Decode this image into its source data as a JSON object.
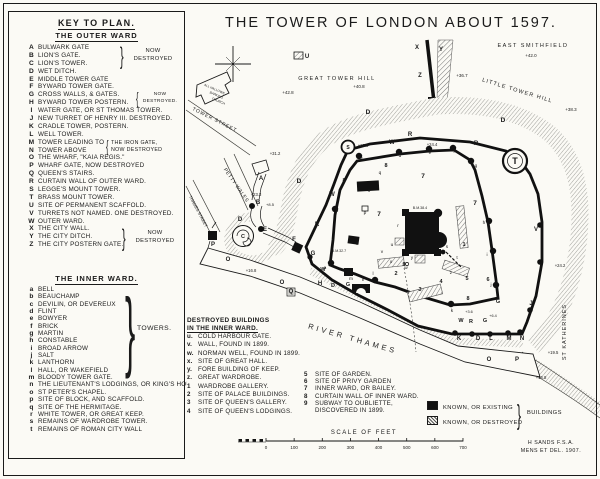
{
  "key": {
    "heading": "KEY TO PLAN.",
    "subheading": "THE OUTER WARD",
    "inner_heading": "THE INNER WARD.",
    "outer_ward": [
      {
        "k": "A",
        "label": "BULWARK GATE"
      },
      {
        "k": "B",
        "label": "LION'S GATE."
      },
      {
        "k": "C",
        "label": "LION'S TOWER."
      },
      {
        "k": "D",
        "label": "WET DITCH."
      },
      {
        "k": "E",
        "label": "MIDDLE TOWER GATE"
      },
      {
        "k": "F",
        "label": "BYWARD TOWER GATE."
      },
      {
        "k": "G",
        "label": "CROSS WALLS, & GATES."
      },
      {
        "k": "H",
        "label": "BYWARD TOWER POSTERN."
      },
      {
        "k": "I",
        "label": "WATER GATE, OR ST THOMAS TOWER."
      },
      {
        "k": "J",
        "label": "NEW TURRET OF HENRY III. DESTROYED."
      },
      {
        "k": "K",
        "label": "CRADLE TOWER, POSTERN."
      },
      {
        "k": "L",
        "label": "WELL TOWER."
      },
      {
        "k": "M",
        "label": "TOWER LEADING TO"
      },
      {
        "k": "N",
        "label": "TOWER ABOVE"
      },
      {
        "k": "O",
        "label": "THE WHARF, \"KAIA REGIS.\""
      },
      {
        "k": "P",
        "label": "WHARF GATE, NOW DESTROYED"
      },
      {
        "k": "Q",
        "label": "QUEEN'S STAIRS."
      },
      {
        "k": "R",
        "label": "CURTAIN WALL OF OUTER WARD."
      },
      {
        "k": "S",
        "label": "LEGGE'S MOUNT TOWER."
      },
      {
        "k": "T",
        "label": "BRASS MOUNT TOWER."
      },
      {
        "k": "U",
        "label": "SITE OF PERMANENT SCAFFOLD."
      },
      {
        "k": "V",
        "label": "TURRETS NOT NAMED. ONE DESTROYED."
      },
      {
        "k": "W",
        "label": "OUTER WARD."
      },
      {
        "k": "X",
        "label": "THE CITY WALL."
      },
      {
        "k": "Y",
        "label": "THE CITY DITCH."
      },
      {
        "k": "Z",
        "label": "THE CITY POSTERN GATE."
      }
    ],
    "inner_ward": [
      {
        "k": "a",
        "label": "BELL"
      },
      {
        "k": "b",
        "label": "BEAUCHAMP"
      },
      {
        "k": "c",
        "label": "DEVILIN, OR DEVEREUX"
      },
      {
        "k": "d",
        "label": "FLINT"
      },
      {
        "k": "e",
        "label": "BOWYER"
      },
      {
        "k": "f",
        "label": "BRICK"
      },
      {
        "k": "g",
        "label": "MARTIN"
      },
      {
        "k": "h",
        "label": "CONSTABLE"
      },
      {
        "k": "i",
        "label": "BROAD ARROW"
      },
      {
        "k": "j",
        "label": "SALT"
      },
      {
        "k": "k",
        "label": "LANTHORN"
      },
      {
        "k": "l",
        "label": "HALL, OR WAKEFIELD"
      },
      {
        "k": "m",
        "label": "BLOODY TOWER GATE."
      },
      {
        "k": "n",
        "label": "THE LIEUTENANT'S LODGINGS, OR KING'S HOUSE"
      },
      {
        "k": "o",
        "label": "ST PETER'S CHAPEL."
      },
      {
        "k": "p",
        "label": "SITE OF BLOCK, AND SCAFFOLD."
      },
      {
        "k": "q",
        "label": "SITE OF THE HERMITAGE."
      },
      {
        "k": "r",
        "label": "WHITE TOWER, OR GREAT KEEP."
      },
      {
        "k": "s",
        "label": "REMAINS OF WARDROBE TOWER."
      },
      {
        "k": "t",
        "label": "REMAINS OF ROMAN CITY WALL"
      }
    ],
    "towers_brace_label": "TOWERS.",
    "braces": {
      "abc": [
        "NOW",
        "DESTROYED"
      ],
      "gh": [
        "NOW",
        "DESTROYED."
      ],
      "mn": [
        "THE IRON GATE,",
        "NOW DESTROYED"
      ],
      "xyz": [
        "NOW",
        "DESTROYED"
      ]
    },
    "brace_glyphs": {
      "close": "}",
      "open": "{"
    }
  },
  "destroyed": {
    "heading1": "DESTROYED BUILDINGS",
    "heading2": "IN THE INNER WARD.",
    "col1": [
      {
        "k": "u.",
        "label": "COLD HARBOUR GATE."
      },
      {
        "k": "v.",
        "label": "WALL, FOUND IN 1899."
      },
      {
        "k": "w.",
        "label": "NORMAN WELL, FOUND IN 1899."
      },
      {
        "k": "x.",
        "label": "SITE OF GREAT HALL."
      },
      {
        "k": "y.",
        "label": "FORE BUILDING OF KEEP."
      },
      {
        "k": "z.",
        "label": "GREAT WARDROBE."
      },
      {
        "k": "1",
        "label": "WARDROBE GALLERY."
      },
      {
        "k": "2",
        "label": "SITE OF PALACE BUILDINGS."
      },
      {
        "k": "3",
        "label": "SITE OF QUEEN'S GALLERY."
      },
      {
        "k": "4",
        "label": "SITE OF QUEEN'S LODGINGS."
      }
    ],
    "col2": [
      {
        "k": "5",
        "label": "SITE OF GARDEN."
      },
      {
        "k": "6",
        "label": "SITE OF PRIVY GARDEN"
      },
      {
        "k": "7",
        "label": "INNER WARD, OR BAILEY."
      },
      {
        "k": "8",
        "label": "CURTAIN WALL OF INNER WARD."
      },
      {
        "k": "9",
        "label": "SUBWAY TO OUBLIETTE,"
      },
      {
        "k": "",
        "label": "DISCOVERED IN 1899."
      }
    ]
  },
  "legend": {
    "existing": "KNOWN, OR EXISTING",
    "destroyed": "KNOWN, OR DESTROYED",
    "brace_label": "BUILDINGS"
  },
  "scale": {
    "label": "SCALE OF FEET",
    "ticks": [
      "0",
      "100",
      "200",
      "300",
      "400",
      "500",
      "600",
      "700"
    ]
  },
  "signature": {
    "line1": "H SANDS  F.S.A.",
    "line2": "MENS ET DEL. 1907."
  },
  "map": {
    "markers": [
      {
        "t": "THE TOWER OF LONDON ABOUT 1597.",
        "x": 391,
        "y": 27,
        "fs": 14.5,
        "ls": 2,
        "n": "map-title"
      },
      {
        "t": "EAST SMITHFIELD",
        "x": 533,
        "y": 47,
        "fs": 5.5,
        "ls": 1.5,
        "n": "east-smithfield-label"
      },
      {
        "t": "+42.0",
        "x": 531,
        "y": 57,
        "fs": 4.5
      },
      {
        "t": "GREAT TOWER HILL",
        "x": 337,
        "y": 80,
        "fs": 5.5,
        "ls": 1.5,
        "n": "great-tower-hill-label"
      },
      {
        "t": "+40.8",
        "x": 359,
        "y": 88,
        "fs": 4.5
      },
      {
        "t": "+42.8",
        "x": 288,
        "y": 94,
        "fs": 4.5
      },
      {
        "t": "LITTLE TOWER HILL",
        "x": 517,
        "y": 92,
        "fs": 5.5,
        "ls": 1.2,
        "r": 17,
        "n": "little-tower-hill-label"
      },
      {
        "t": "+38.3",
        "x": 571,
        "y": 111,
        "fs": 4.5
      },
      {
        "t": "+36.7",
        "x": 462,
        "y": 77,
        "fs": 4.5
      },
      {
        "t": "+31.2",
        "x": 275,
        "y": 155,
        "fs": 4.2
      },
      {
        "t": "TOWER STREET",
        "x": 214,
        "y": 121,
        "fs": 5,
        "ls": 0.8,
        "r": 27,
        "n": "tower-street-label"
      },
      {
        "t": "PETTY WALES",
        "x": 235,
        "y": 186,
        "fs": 5,
        "ls": 0.5,
        "r": 55,
        "n": "petty-wales-label"
      },
      {
        "t": "THAMES STREET",
        "x": 197,
        "y": 212,
        "fs": 4.2,
        "r": 62,
        "n": "thames-street-label"
      },
      {
        "t": "ALL HALLOWS",
        "x": 214,
        "y": 90,
        "fs": 3.2,
        "r": 24
      },
      {
        "t": "BARKING",
        "x": 216,
        "y": 96,
        "fs": 3.2,
        "r": 24
      },
      {
        "t": "CHURCH",
        "x": 218,
        "y": 102,
        "fs": 3.2,
        "r": 24
      },
      {
        "t": "RIVER THAMES",
        "x": 352,
        "y": 341,
        "fs": 7.5,
        "ls": 3,
        "r": 16,
        "n": "river-thames-label"
      },
      {
        "t": "ST KATHERINES",
        "x": 566,
        "y": 332,
        "fs": 5.5,
        "ls": 1,
        "r": -90,
        "n": "st-katherines-label"
      },
      {
        "t": "+24.2",
        "x": 560,
        "y": 267,
        "fs": 4.2
      },
      {
        "t": "+19.5",
        "x": 553,
        "y": 354,
        "fs": 4.2
      },
      {
        "t": "+16.8",
        "x": 541,
        "y": 379,
        "fs": 4.2
      },
      {
        "t": "+16.8",
        "x": 251,
        "y": 272,
        "fs": 4.2
      },
      {
        "t": "+25.8",
        "x": 363,
        "y": 147,
        "fs": 4.2
      },
      {
        "t": "+24.4",
        "x": 432,
        "y": 146,
        "fs": 4.2
      },
      {
        "t": "+23.3",
        "x": 256,
        "y": 196,
        "fs": 4.2
      },
      {
        "t": "+8.5",
        "x": 270,
        "y": 206,
        "fs": 4
      },
      {
        "t": "+3.6",
        "x": 469,
        "y": 313,
        "fs": 3.8
      },
      {
        "t": "+6.4",
        "x": 493,
        "y": 317,
        "fs": 3.8
      },
      {
        "t": "B.M.38.4",
        "x": 420,
        "y": 209,
        "fs": 3.6
      },
      {
        "t": "B.M.32.7",
        "x": 339,
        "y": 252,
        "fs": 3.6
      },
      {
        "t": "X",
        "x": 417,
        "y": 49,
        "fs": 6,
        "b": 1
      },
      {
        "t": "Y",
        "x": 441,
        "y": 51,
        "fs": 6,
        "b": 1
      },
      {
        "t": "Z",
        "x": 420,
        "y": 77,
        "fs": 6,
        "b": 1
      },
      {
        "t": "U",
        "x": 307,
        "y": 58,
        "fs": 6,
        "b": 1
      },
      {
        "t": "S",
        "x": 348,
        "y": 149,
        "fs": 5,
        "b": 1
      },
      {
        "t": "T",
        "x": 515,
        "y": 164,
        "fs": 9,
        "b": 1
      },
      {
        "t": "A",
        "x": 261,
        "y": 180,
        "fs": 6,
        "b": 1
      },
      {
        "t": "B",
        "x": 258,
        "y": 204,
        "fs": 6,
        "b": 1
      },
      {
        "t": "C",
        "x": 243,
        "y": 238,
        "fs": 5.5,
        "b": 1
      },
      {
        "t": "E",
        "x": 265,
        "y": 231,
        "fs": 6,
        "b": 1
      },
      {
        "t": "P",
        "x": 213,
        "y": 246,
        "fs": 6,
        "b": 1
      },
      {
        "t": "F",
        "x": 294,
        "y": 241,
        "fs": 6,
        "b": 1
      },
      {
        "t": "G",
        "x": 313,
        "y": 255,
        "fs": 6,
        "b": 1
      },
      {
        "t": "H",
        "x": 320,
        "y": 285,
        "fs": 6,
        "b": 1
      },
      {
        "t": "I",
        "x": 363,
        "y": 281,
        "fs": 6,
        "b": 1
      },
      {
        "t": "Q",
        "x": 291,
        "y": 293,
        "fs": 6,
        "b": 1
      },
      {
        "t": "O",
        "x": 228,
        "y": 261,
        "fs": 6,
        "b": 1
      },
      {
        "t": "O",
        "x": 282,
        "y": 284,
        "fs": 6,
        "b": 1
      },
      {
        "t": "O",
        "x": 489,
        "y": 361,
        "fs": 6,
        "b": 1
      },
      {
        "t": "P",
        "x": 517,
        "y": 361,
        "fs": 6,
        "b": 1
      },
      {
        "t": "K",
        "x": 459,
        "y": 340,
        "fs": 6,
        "b": 1
      },
      {
        "t": "D",
        "x": 478,
        "y": 340,
        "fs": 6,
        "b": 1
      },
      {
        "t": "L",
        "x": 491,
        "y": 340,
        "fs": 6,
        "b": 1
      },
      {
        "t": "M",
        "x": 509,
        "y": 340,
        "fs": 6,
        "b": 1
      },
      {
        "t": "N",
        "x": 522,
        "y": 340,
        "fs": 6,
        "b": 1
      },
      {
        "t": "D",
        "x": 368,
        "y": 114,
        "fs": 6.5,
        "b": 1
      },
      {
        "t": "D",
        "x": 503,
        "y": 122,
        "fs": 6.5,
        "b": 1
      },
      {
        "t": "D",
        "x": 299,
        "y": 183,
        "fs": 6.5,
        "b": 1
      },
      {
        "t": "D",
        "x": 240,
        "y": 221,
        "fs": 6,
        "b": 1
      },
      {
        "t": "D",
        "x": 333,
        "y": 287,
        "fs": 5.5,
        "b": 1
      },
      {
        "t": "W",
        "x": 392,
        "y": 144,
        "fs": 6,
        "b": 1
      },
      {
        "t": "W",
        "x": 332,
        "y": 196,
        "fs": 6,
        "b": 1
      },
      {
        "t": "W",
        "x": 323,
        "y": 271,
        "fs": 5.5,
        "b": 1
      },
      {
        "t": "W",
        "x": 461,
        "y": 322,
        "fs": 5.5,
        "b": 1
      },
      {
        "t": "R",
        "x": 410,
        "y": 136,
        "fs": 6,
        "b": 1
      },
      {
        "t": "R",
        "x": 317,
        "y": 226,
        "fs": 6,
        "b": 1
      },
      {
        "t": "R",
        "x": 476,
        "y": 145,
        "fs": 6,
        "b": 1
      },
      {
        "t": "R",
        "x": 471,
        "y": 323,
        "fs": 5.5,
        "b": 1
      },
      {
        "t": "G",
        "x": 485,
        "y": 322,
        "fs": 5.5,
        "b": 1
      },
      {
        "t": "G",
        "x": 498,
        "y": 303,
        "fs": 5.5,
        "b": 1
      },
      {
        "t": "G",
        "x": 348,
        "y": 286,
        "fs": 5.5,
        "b": 1
      },
      {
        "t": "V",
        "x": 536,
        "y": 231,
        "fs": 6,
        "b": 1
      },
      {
        "t": "J",
        "x": 531,
        "y": 305,
        "fs": 6,
        "b": 1
      },
      {
        "t": "a",
        "x": 325,
        "y": 269,
        "fs": 4.8
      },
      {
        "t": "b",
        "x": 337,
        "y": 212,
        "fs": 4.8
      },
      {
        "t": "c",
        "x": 362,
        "y": 160,
        "fs": 4.8
      },
      {
        "t": "d",
        "x": 400,
        "y": 157,
        "fs": 4.8
      },
      {
        "t": "e",
        "x": 430,
        "y": 154,
        "fs": 4.8
      },
      {
        "t": "f",
        "x": 454,
        "y": 153,
        "fs": 4.8
      },
      {
        "t": "g",
        "x": 476,
        "y": 167,
        "fs": 4.8
      },
      {
        "t": "h",
        "x": 484,
        "y": 224,
        "fs": 4.8
      },
      {
        "t": "i",
        "x": 487,
        "y": 256,
        "fs": 4.8
      },
      {
        "t": "j",
        "x": 491,
        "y": 286,
        "fs": 4.8
      },
      {
        "t": "k",
        "x": 452,
        "y": 312,
        "fs": 4.8
      },
      {
        "t": "l",
        "x": 373,
        "y": 275,
        "fs": 4.8
      },
      {
        "t": "m",
        "x": 351,
        "y": 280,
        "fs": 4.8
      },
      {
        "t": "n",
        "x": 357,
        "y": 245,
        "fs": 4.8
      },
      {
        "t": "o",
        "x": 369,
        "y": 192,
        "fs": 4.8
      },
      {
        "t": "p",
        "x": 365,
        "y": 214,
        "fs": 4.8
      },
      {
        "t": "q",
        "x": 380,
        "y": 174,
        "fs": 4.8
      },
      {
        "t": "r",
        "x": 398,
        "y": 227,
        "fs": 4.8
      },
      {
        "t": "s",
        "x": 447,
        "y": 248,
        "fs": 4.8
      },
      {
        "t": "t",
        "x": 457,
        "y": 259,
        "fs": 4.8
      },
      {
        "t": "u",
        "x": 392,
        "y": 246,
        "fs": 4.8
      },
      {
        "t": "v",
        "x": 382,
        "y": 253,
        "fs": 4.8
      },
      {
        "t": "w",
        "x": 406,
        "y": 269,
        "fs": 4.8
      },
      {
        "t": "x",
        "x": 391,
        "y": 263,
        "fs": 4.8
      },
      {
        "t": "y",
        "x": 412,
        "y": 259,
        "fs": 4.8
      },
      {
        "t": "z",
        "x": 451,
        "y": 274,
        "fs": 4.8
      },
      {
        "t": "1",
        "x": 464,
        "y": 246,
        "fs": 5.5,
        "b": 1
      },
      {
        "t": "2",
        "x": 396,
        "y": 275,
        "fs": 5.5,
        "b": 1
      },
      {
        "t": "3",
        "x": 420,
        "y": 291,
        "fs": 5.5,
        "b": 1
      },
      {
        "t": "4",
        "x": 441,
        "y": 283,
        "fs": 5.5,
        "b": 1
      },
      {
        "t": "5",
        "x": 467,
        "y": 280,
        "fs": 5.5,
        "b": 1
      },
      {
        "t": "6",
        "x": 488,
        "y": 281,
        "fs": 5.5,
        "b": 1
      },
      {
        "t": "7",
        "x": 423,
        "y": 178,
        "fs": 6.5,
        "b": 1
      },
      {
        "t": "7",
        "x": 475,
        "y": 205,
        "fs": 6.5,
        "b": 1
      },
      {
        "t": "7",
        "x": 379,
        "y": 216,
        "fs": 6.5,
        "b": 1
      },
      {
        "t": "8",
        "x": 386,
        "y": 167,
        "fs": 5.5,
        "b": 1
      },
      {
        "t": "8",
        "x": 344,
        "y": 182,
        "fs": 5.5,
        "b": 1
      },
      {
        "t": "8",
        "x": 468,
        "y": 300,
        "fs": 5.5,
        "b": 1
      },
      {
        "t": "9",
        "x": 404,
        "y": 266,
        "fs": 5.5,
        "b": 1
      }
    ]
  }
}
